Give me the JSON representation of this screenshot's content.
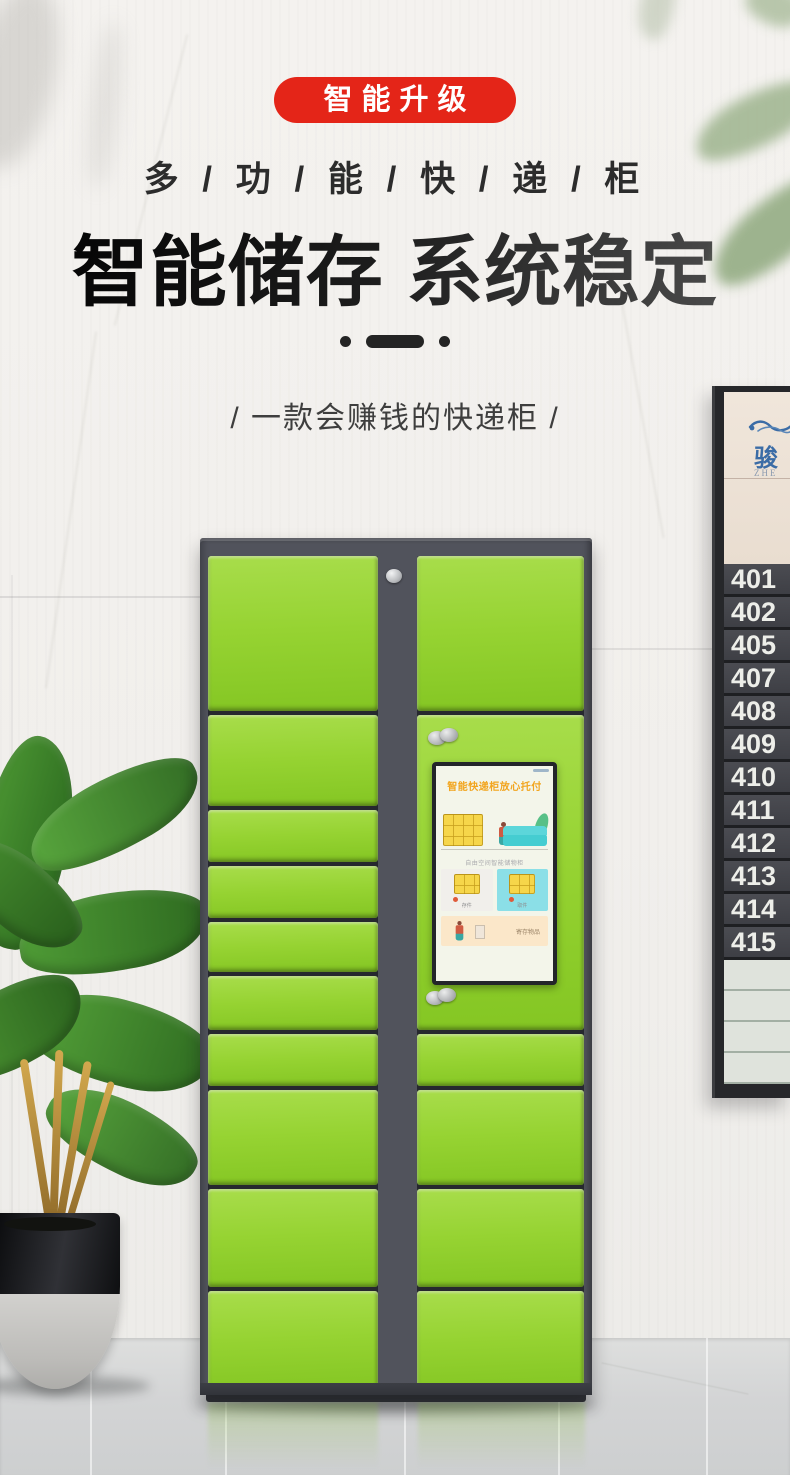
{
  "hero": {
    "badge_label": "智能升级",
    "subtitle": "多 / 功 / 能 / 快 / 递 / 柜",
    "title": "智能储存 系统稳定",
    "tagline": "/ 一款会赚钱的快递柜 /",
    "badge_color": "#e42518",
    "title_color": "#141414"
  },
  "locker": {
    "door_color": "#96d332",
    "frame_color": "#51535c",
    "screen": {
      "title": "智能快递柜放心托付",
      "subtitle": "自由空间智能储物柜",
      "card_deposit_label": "存件",
      "card_pickup_label": "取件",
      "bottom_card_label": "寄存物品"
    }
  },
  "room_sign": {
    "logo_text": "骏",
    "logo_subtext": "ZHE",
    "rooms": [
      "401",
      "402",
      "405",
      "407",
      "408",
      "409",
      "410",
      "411",
      "412",
      "413",
      "414",
      "415"
    ]
  }
}
